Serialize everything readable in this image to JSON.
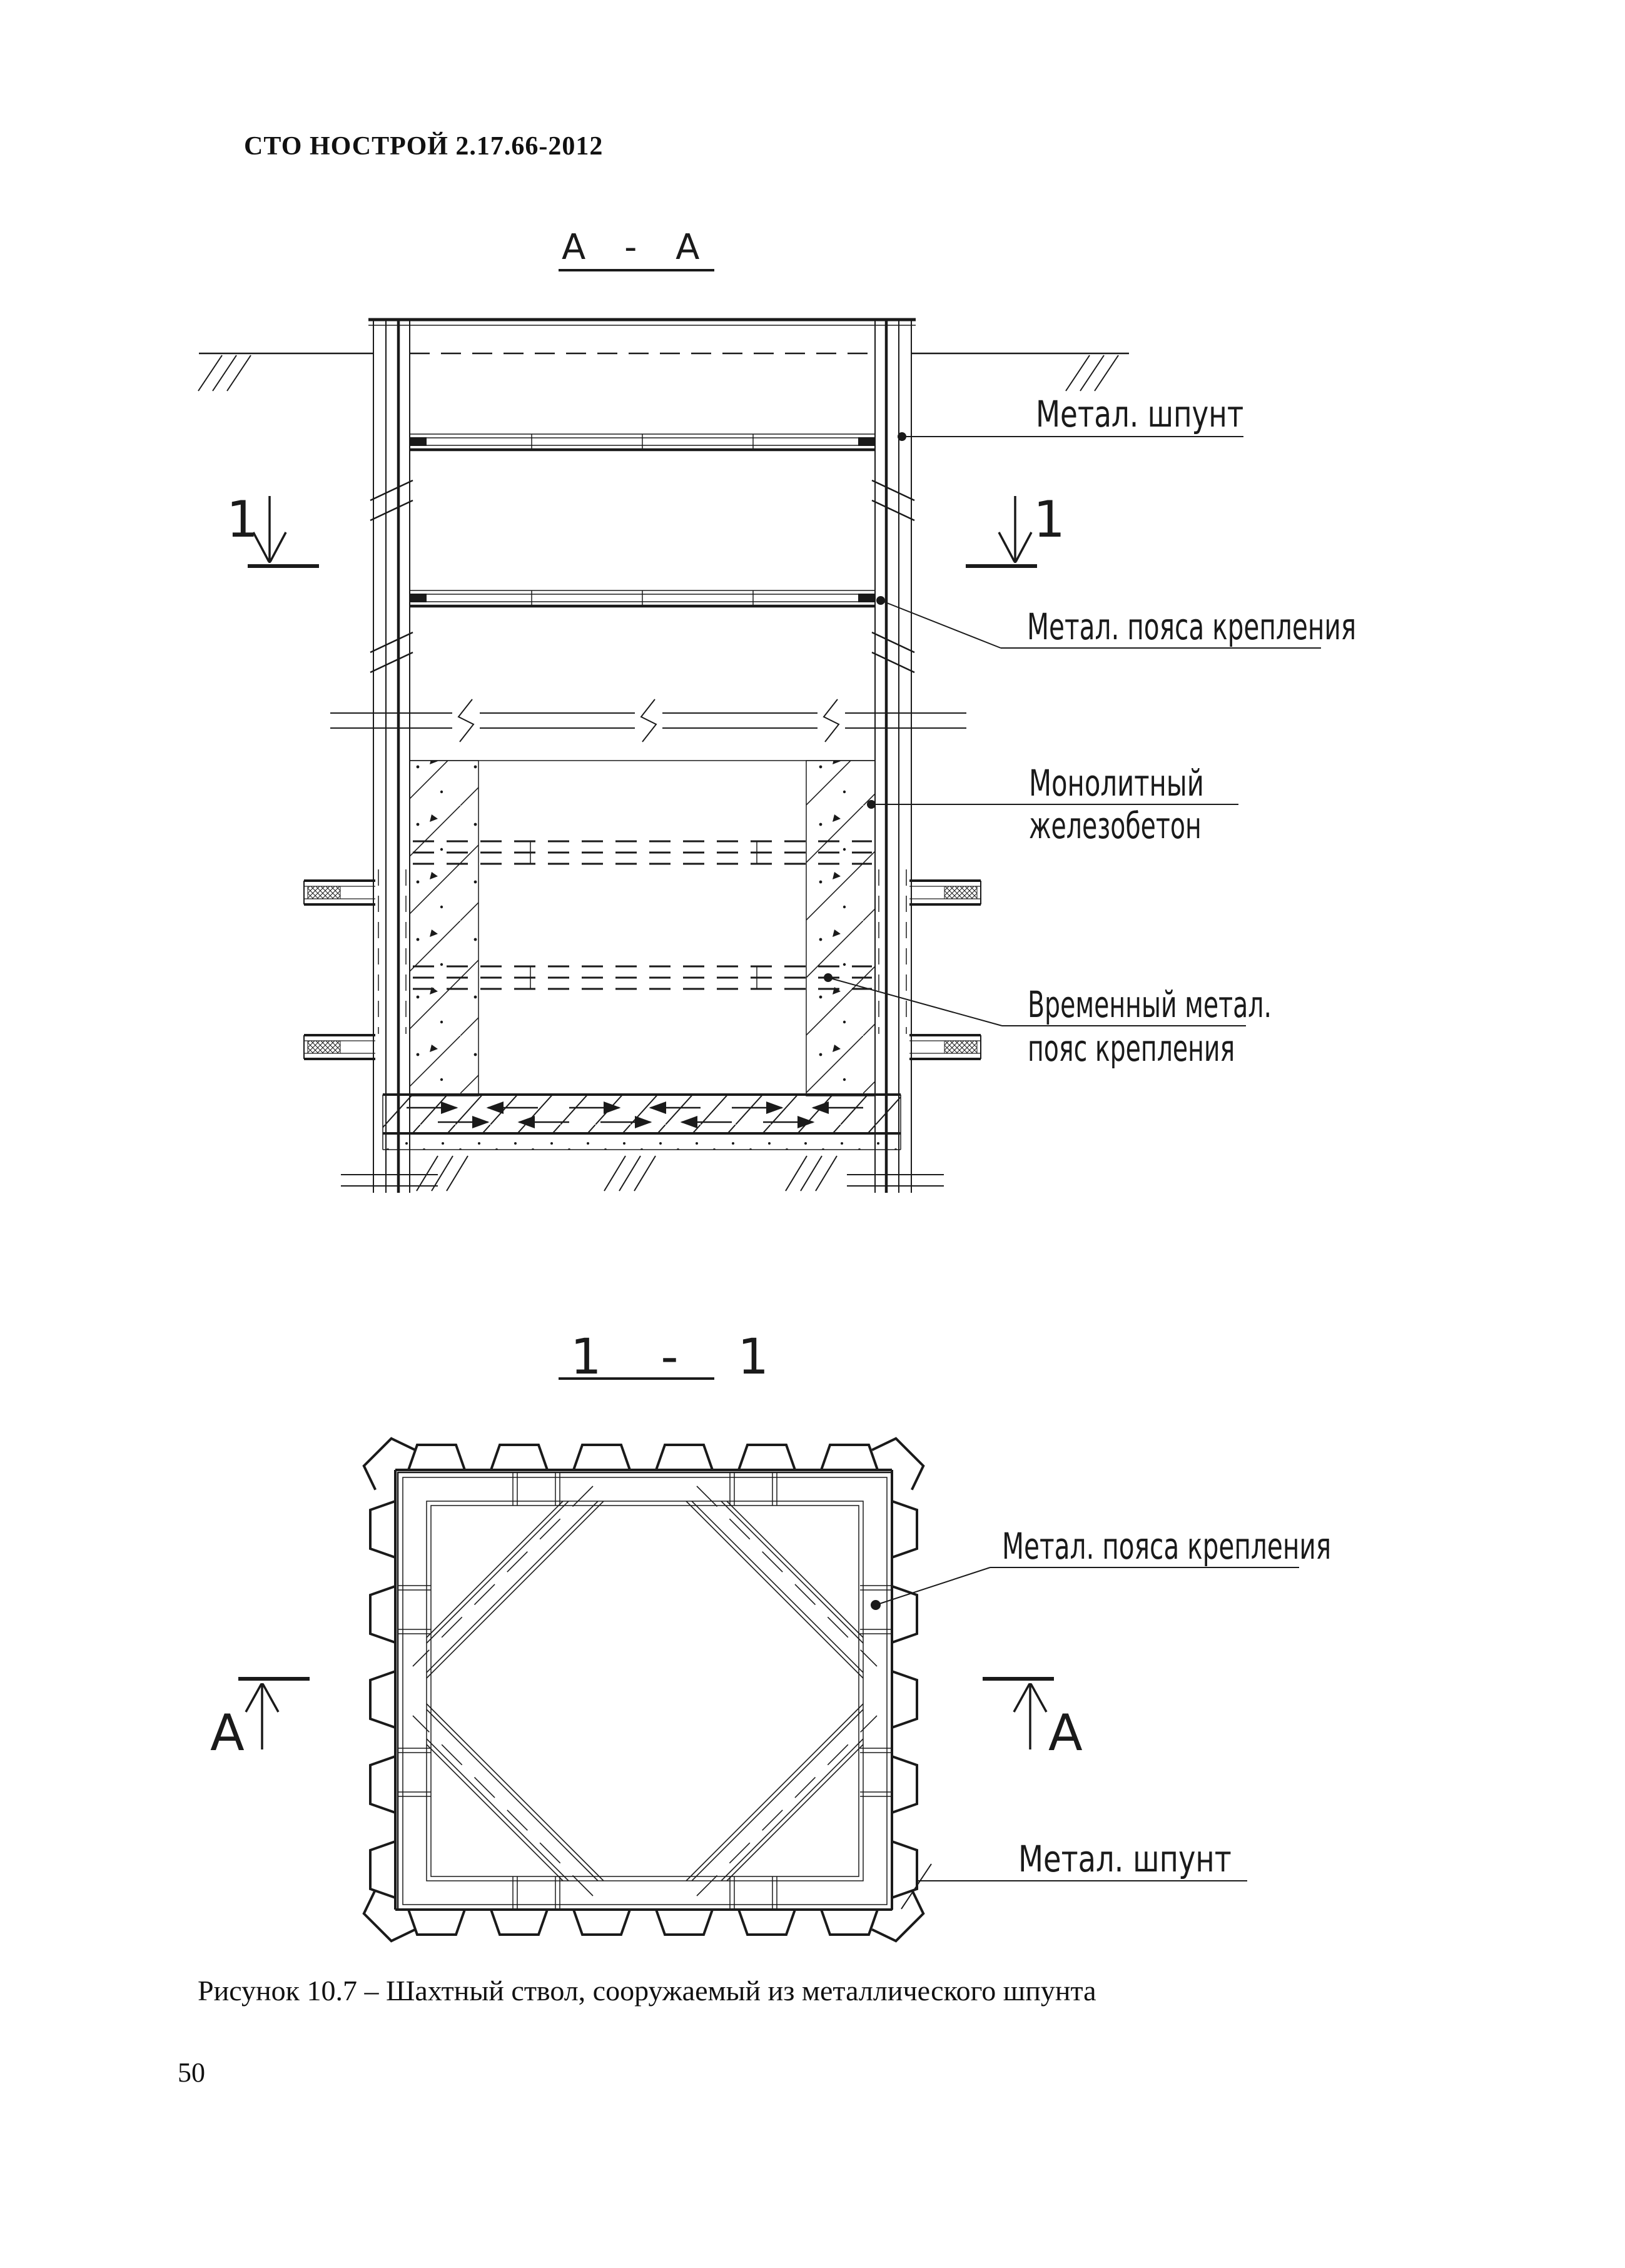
{
  "page": {
    "header": "СТО НОСТРОЙ 2.17.66-2012",
    "caption": "Рисунок 10.7 – Шахтный ствол, сооружаемый из металлического шпунта",
    "page_number": "50"
  },
  "section_aa": {
    "title": "А - А",
    "cut_marker": "1",
    "labels": {
      "sheet_pile": "Метал. шпунт",
      "belts": "Метал. пояса крепления",
      "concrete_line1": "Монолитный",
      "concrete_line2": "железобетон",
      "temp_belt_line1": "Временный метал.",
      "temp_belt_line2": "пояс крепления"
    }
  },
  "section_11": {
    "title": "1 - 1",
    "cut_marker": "А",
    "labels": {
      "belts": "Метал. пояса крепления",
      "sheet_pile": "Метал. шпунт"
    }
  },
  "colors": {
    "line": "#1a1a1a",
    "background": "#ffffff"
  }
}
